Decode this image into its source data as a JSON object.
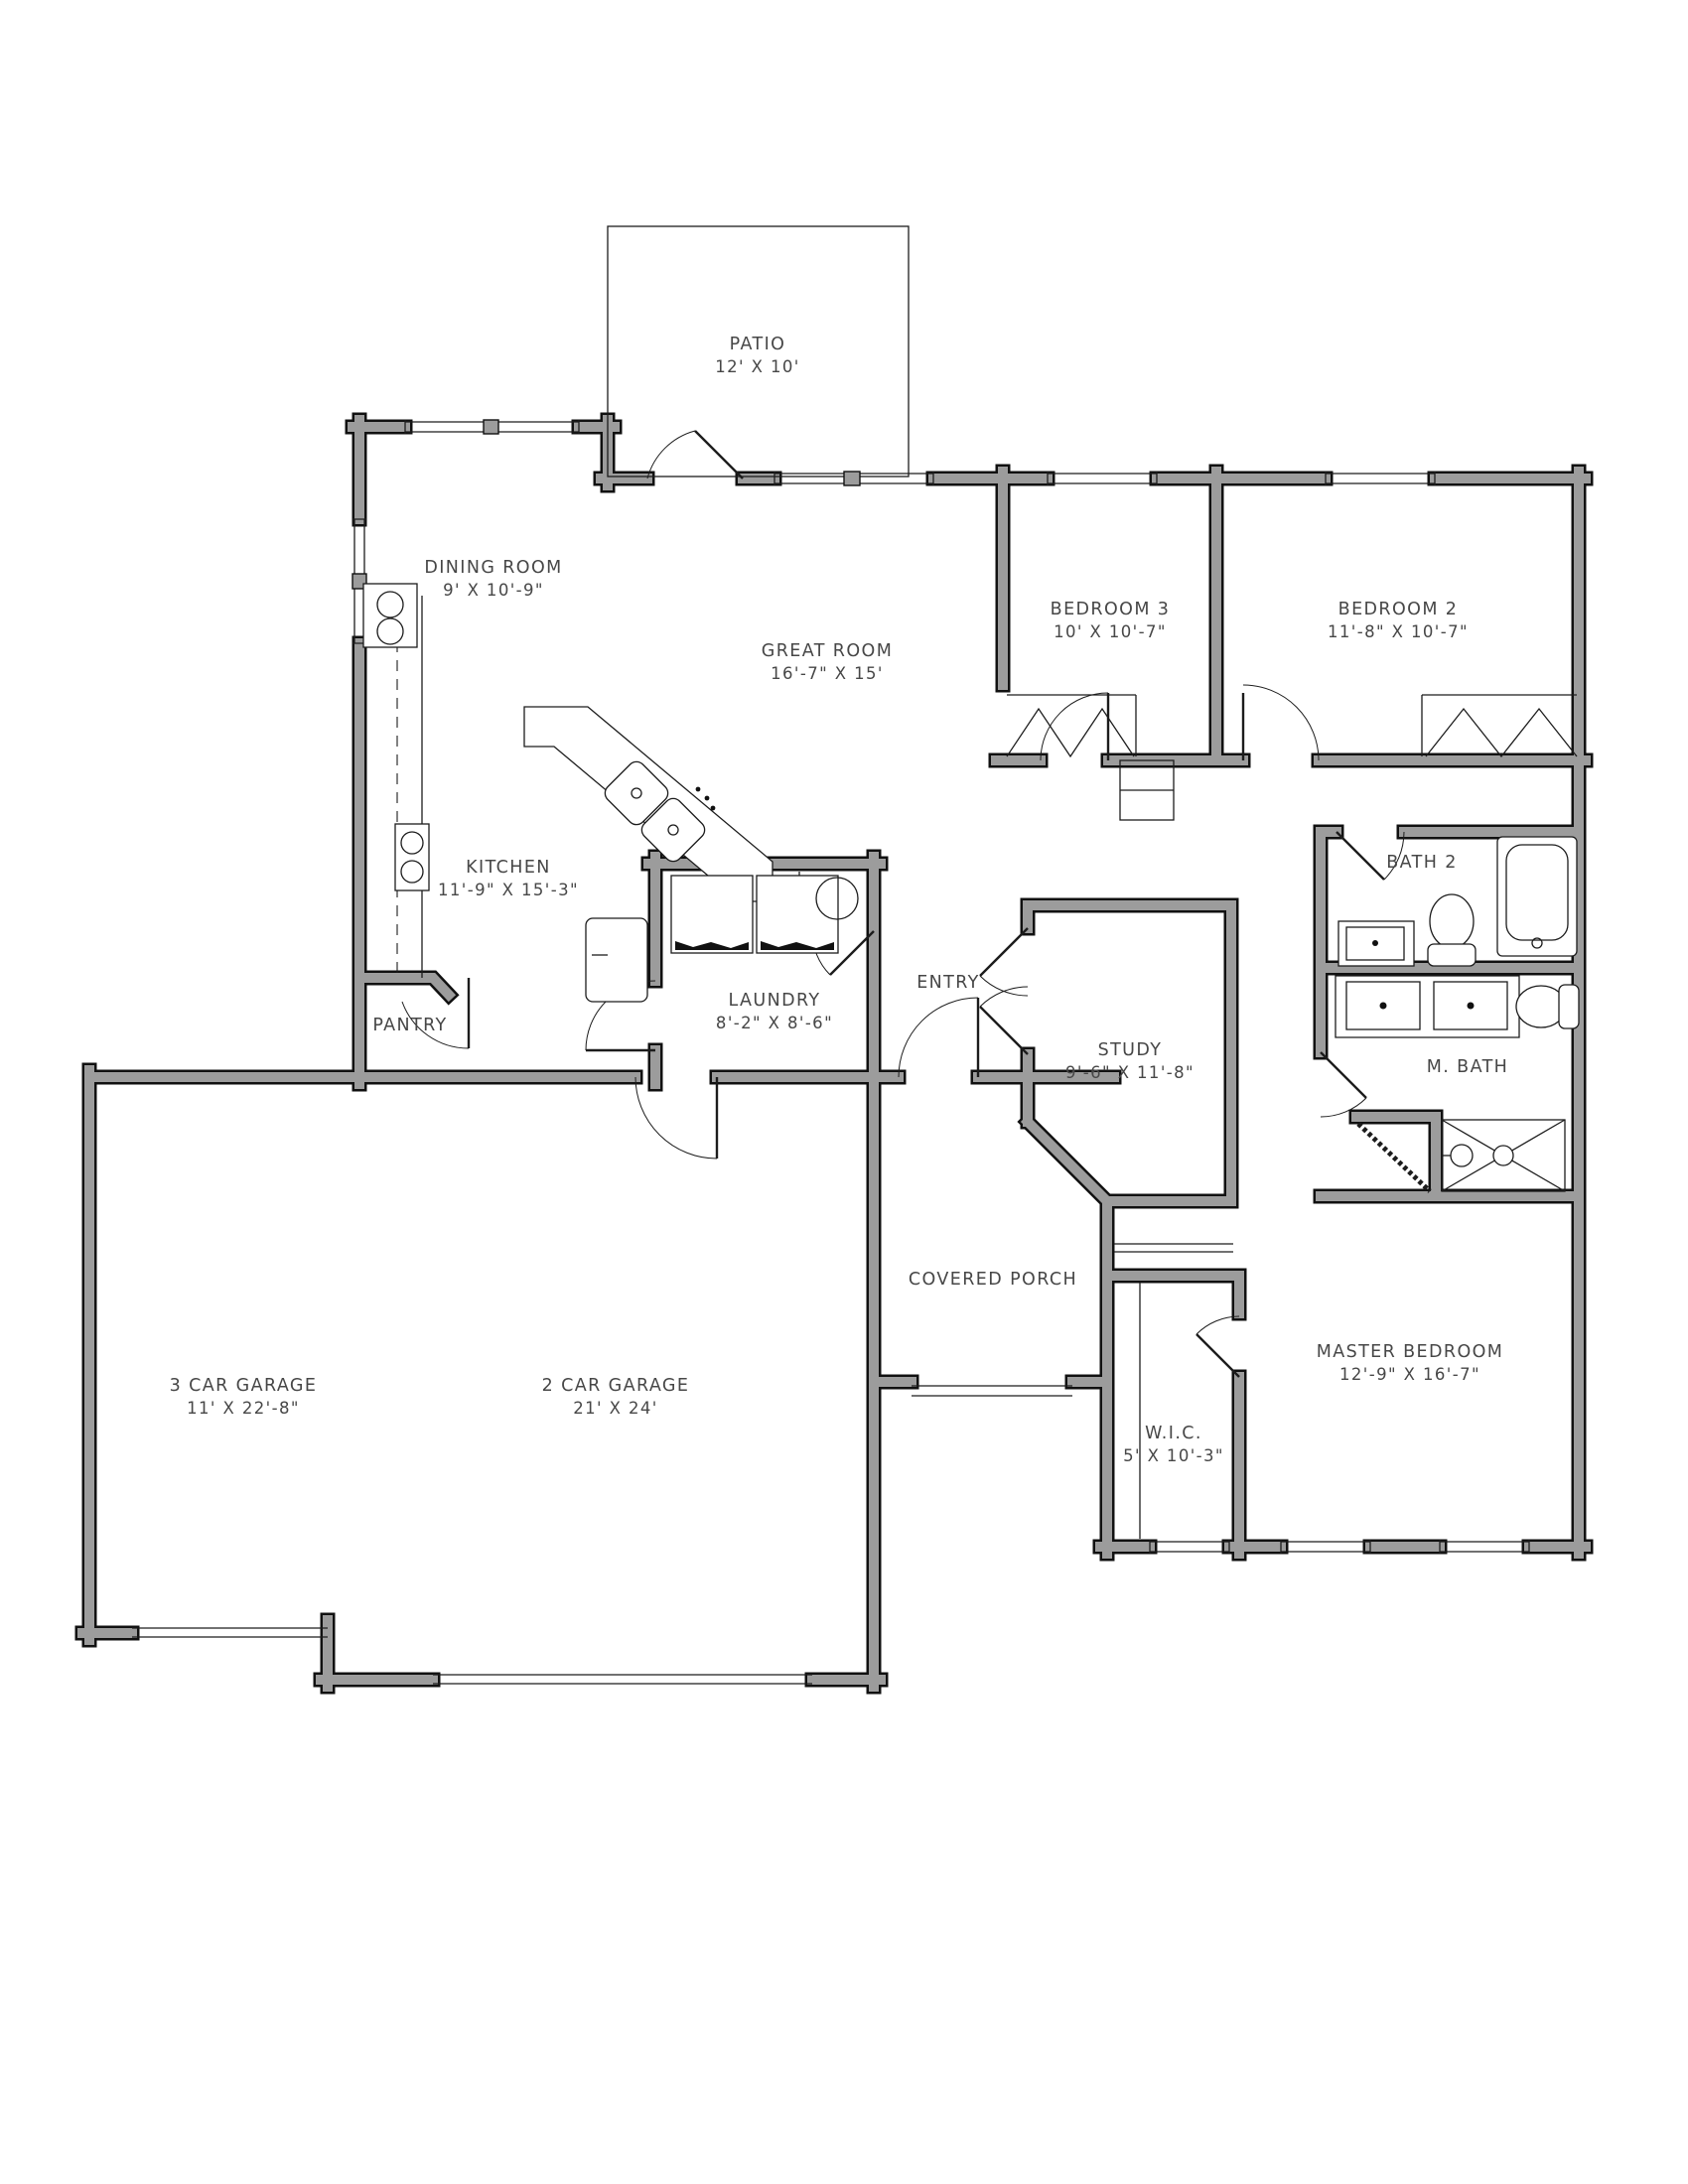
{
  "plan": {
    "kind": "residential floor plan",
    "colors": {
      "wall_fill": "#9c9c9c",
      "wall_edge": "#111111",
      "thin_line": "#1c1c1c",
      "label_text": "#474747",
      "background": "#ffffff"
    },
    "rooms": {
      "patio": {
        "name": "PATIO",
        "dims": "12' X 10'"
      },
      "dining": {
        "name": "DINING ROOM",
        "dims": "9' X 10'-9\""
      },
      "great": {
        "name": "GREAT ROOM",
        "dims": "16'-7\" X 15'"
      },
      "bed3": {
        "name": "BEDROOM 3",
        "dims": "10' X 10'-7\""
      },
      "bed2": {
        "name": "BEDROOM 2",
        "dims": "11'-8\" X 10'-7\""
      },
      "kitchen": {
        "name": "KITCHEN",
        "dims": "11'-9\" X 15'-3\""
      },
      "bath2": {
        "name": "BATH 2",
        "dims": ""
      },
      "laundry": {
        "name": "LAUNDRY",
        "dims": "8'-2\" X 8'-6\""
      },
      "entry": {
        "name": "ENTRY",
        "dims": ""
      },
      "study": {
        "name": "STUDY",
        "dims": "9'-6\" X 11'-8\""
      },
      "mbath": {
        "name": "M. BATH",
        "dims": ""
      },
      "pantry": {
        "name": "PANTRY",
        "dims": ""
      },
      "porch": {
        "name": "COVERED PORCH",
        "dims": ""
      },
      "garage3": {
        "name": "3 CAR GARAGE",
        "dims": "11' X 22'-8\""
      },
      "garage2": {
        "name": "2 CAR GARAGE",
        "dims": "21' X 24'"
      },
      "master": {
        "name": "MASTER BEDROOM",
        "dims": "12'-9\" X 16'-7\""
      },
      "wic": {
        "name": "W.I.C.",
        "dims": "5' X 10'-3\""
      }
    }
  }
}
